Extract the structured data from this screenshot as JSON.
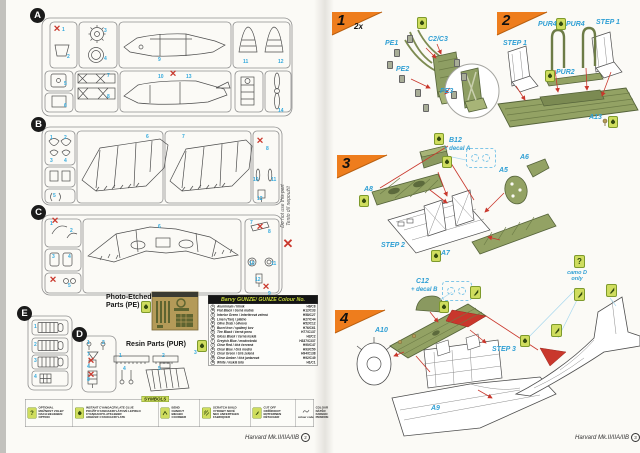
{
  "doc": {
    "footer_title": "Harvard Mk.II/IIA/IIB",
    "left_page_no": "2",
    "right_page_no": "3"
  },
  "sprues": {
    "a": {
      "letter": "A",
      "nums": [
        "1",
        "2",
        "3",
        "4",
        "9",
        "11",
        "12",
        "5",
        "6",
        "7",
        "8",
        "10",
        "13",
        "14"
      ]
    },
    "b": {
      "letter": "B",
      "nums": [
        "1",
        "2",
        "3",
        "4",
        "5",
        "6",
        "7",
        "8",
        "10",
        "11",
        "12"
      ]
    },
    "c": {
      "letter": "C",
      "nums": [
        "1",
        "2",
        "3",
        "4",
        "5",
        "6",
        "7",
        "8",
        "10",
        "11",
        "12",
        "9"
      ]
    },
    "d": {
      "letter": "D",
      "nums": [
        "1",
        "2",
        "7",
        "4",
        "8"
      ]
    },
    "e": {
      "letter": "E",
      "nums": [
        "1",
        "2",
        "3",
        "4"
      ]
    }
  },
  "margin_note": {
    "line1": "Do not use this part",
    "line2": "Tento díl nepoužít"
  },
  "pe": {
    "label_line1": "Photo-Etched",
    "label_line2": "Parts (PE)"
  },
  "resin": {
    "label": "Resin Parts (PUR)",
    "nums": [
      "1",
      "2",
      "3",
      "4",
      "5"
    ]
  },
  "colour_table": {
    "title": "Barvy GUNZE/ GUNZE Colour No.",
    "rows": [
      {
        "letter": "A",
        "name": "Aluminium / hliník",
        "code": "H8/C8"
      },
      {
        "letter": "B",
        "name": "Flat Black / černá matná",
        "code": "H12/C33"
      },
      {
        "letter": "C",
        "name": "Interior Green / interiérová zelená",
        "code": "H58/C27"
      },
      {
        "letter": "D",
        "name": "Linen (Tan) / plátno",
        "code": "H27/C44"
      },
      {
        "letter": "E",
        "name": "Olive Drab / olivová",
        "code": "H52/C12"
      },
      {
        "letter": "F",
        "name": "Burnt Iron / spálený kov",
        "code": "H76/C61"
      },
      {
        "letter": "G",
        "name": "Tire Black / černá pneu",
        "code": "H77/C137"
      },
      {
        "letter": "H",
        "name": "Gloss Black / černá lesklá",
        "code": "H2/C2"
      },
      {
        "letter": "I",
        "name": "Greyish Blue / modrošedá",
        "code": "H337/C337"
      },
      {
        "letter": "J",
        "name": "Clear Red / čirá červená",
        "code": "H90/C47"
      },
      {
        "letter": "K",
        "name": "Clear Blue / čirá modrá",
        "code": "H93/C50"
      },
      {
        "letter": "L",
        "name": "Clear Green / čirá zelená",
        "code": "H94/C138"
      },
      {
        "letter": "M",
        "name": "Clear Amber / čirá jantarová",
        "code": "H92/C49"
      },
      {
        "letter": "N",
        "name": "White / lesklá bílá",
        "code": "H1/C1"
      }
    ]
  },
  "symbols": {
    "title": "SYMBOLS",
    "colour_code_caption": "colour code",
    "items": [
      {
        "lines": [
          "OPTIONAL",
          "MOŽNOST VOLBY",
          "NACH BELIEBEN",
          "OPTION"
        ]
      },
      {
        "lines": [
          "INSTANT CYANOACRYLATE GLUE",
          "POUŽÍT KYANOAKRYLÁTOVÉ LEPIDLO",
          "CYANOACRYLATKLEBER",
          "ADHÉSIF CYANOACRYLATE"
        ]
      },
      {
        "lines": [
          "BEND",
          "OHNOUT",
          "BIEGEN",
          "COURBER"
        ]
      },
      {
        "lines": [
          "SCRATCH BUILD",
          "VYROBIT NOVÉ",
          "NEU ANFERTIGEN",
          "FABRIQUER"
        ]
      },
      {
        "lines": [
          "CUT OFF",
          "ODŘÍZNOUT",
          "ENTFERNEN",
          "DÉTACHER"
        ]
      },
      {
        "lines": [
          "COLOUR",
          "NÁTĚR",
          "FARBEN",
          "PEINDRE"
        ]
      }
    ]
  },
  "steps": {
    "s1": {
      "num": "1",
      "qty": "2x",
      "labels": {
        "pe1": "PE1",
        "c2c3": "C2/C3",
        "pe2": "PE2",
        "pe3": "PE3"
      }
    },
    "s2": {
      "num": "2",
      "labels": {
        "pur4a": "PUR4",
        "pur4b": "PUR4",
        "step1a": "STEP 1",
        "step1b": "STEP 1",
        "pur2": "PUR2",
        "a13": "A13"
      }
    },
    "s3": {
      "num": "3",
      "labels": {
        "b12": "B12",
        "decal_a": "+ decal A",
        "a8": "A8",
        "a5": "A5",
        "a6": "A6",
        "a7": "A7",
        "step2": "STEP 2"
      }
    },
    "s4": {
      "num": "4",
      "labels": {
        "c12": "C12",
        "decal_b": "+ decal B",
        "a10": "A10",
        "a9": "A9",
        "step3": "STEP 3"
      }
    },
    "camo_note": "camo D only"
  }
}
